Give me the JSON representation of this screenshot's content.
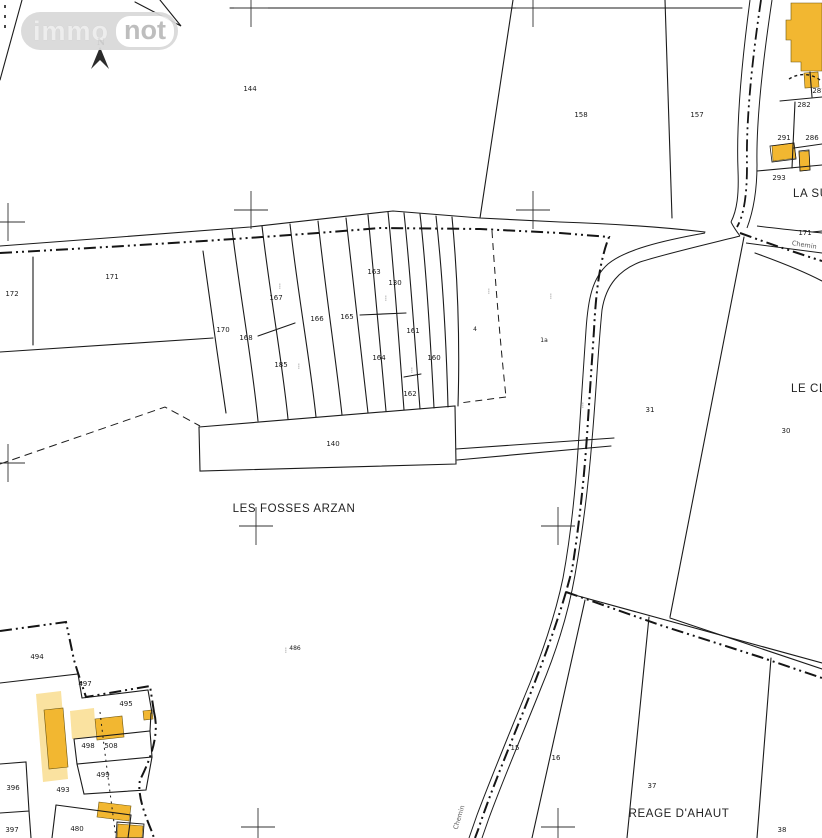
{
  "logo": {
    "immo": "immo",
    "not": "not"
  },
  "north_label": "N",
  "colors": {
    "line": "#1b1b1b",
    "building_dark": "#F2B731",
    "building_light": "#FAE2A0",
    "building_outline": "#6b5510"
  },
  "map": {
    "place_labels": [
      {
        "t": "LES FOSSES ARZAN",
        "x": 294,
        "y": 512,
        "c": "place"
      },
      {
        "t": "REAGE D'AHAUT",
        "x": 679,
        "y": 817,
        "c": "place"
      },
      {
        "t": "LA SU",
        "x": 793,
        "y": 197,
        "c": "place",
        "a": "start"
      },
      {
        "t": "LE CLO",
        "x": 791,
        "y": 392,
        "c": "place",
        "a": "start"
      }
    ],
    "road_labels": [
      {
        "t": "Chemin",
        "x": 804,
        "y": 247,
        "r": 9,
        "c": "road"
      },
      {
        "t": "Chemin",
        "x": 461,
        "y": 818,
        "r": -73,
        "c": "road"
      }
    ],
    "parcel_numbers": [
      {
        "t": "144",
        "x": 250,
        "y": 91
      },
      {
        "t": "158",
        "x": 581,
        "y": 117
      },
      {
        "t": "157",
        "x": 697,
        "y": 117
      },
      {
        "t": "172",
        "x": 12,
        "y": 296
      },
      {
        "t": "171",
        "x": 112,
        "y": 279
      },
      {
        "t": "170",
        "x": 223,
        "y": 332
      },
      {
        "t": "168",
        "x": 246,
        "y": 340
      },
      {
        "t": "167",
        "x": 276,
        "y": 300
      },
      {
        "t": "185",
        "x": 281,
        "y": 367
      },
      {
        "t": "166",
        "x": 317,
        "y": 321
      },
      {
        "t": "165",
        "x": 347,
        "y": 319
      },
      {
        "t": "163",
        "x": 374,
        "y": 274
      },
      {
        "t": "130",
        "x": 395,
        "y": 285
      },
      {
        "t": "164",
        "x": 379,
        "y": 360
      },
      {
        "t": "161",
        "x": 413,
        "y": 333
      },
      {
        "t": "160",
        "x": 434,
        "y": 360
      },
      {
        "t": "162",
        "x": 410,
        "y": 396
      },
      {
        "t": "140",
        "x": 333,
        "y": 446
      },
      {
        "t": "4",
        "x": 475,
        "y": 331,
        "c": "small"
      },
      {
        "t": "1a",
        "x": 544,
        "y": 342,
        "c": "small"
      },
      {
        "t": "486",
        "x": 295,
        "y": 650,
        "c": "small"
      },
      {
        "t": "31",
        "x": 650,
        "y": 412
      },
      {
        "t": "30",
        "x": 786,
        "y": 433
      },
      {
        "t": "15",
        "x": 515,
        "y": 750
      },
      {
        "t": "16",
        "x": 556,
        "y": 760
      },
      {
        "t": "37",
        "x": 652,
        "y": 788
      },
      {
        "t": "38",
        "x": 782,
        "y": 832
      },
      {
        "t": "287",
        "x": 819,
        "y": 93
      },
      {
        "t": "282",
        "x": 804,
        "y": 107
      },
      {
        "t": "291",
        "x": 784,
        "y": 140
      },
      {
        "t": "286",
        "x": 812,
        "y": 140
      },
      {
        "t": "293",
        "x": 779,
        "y": 180
      },
      {
        "t": "171",
        "x": 805,
        "y": 235
      },
      {
        "t": "494",
        "x": 37,
        "y": 659
      },
      {
        "t": "497",
        "x": 85,
        "y": 686
      },
      {
        "t": "495",
        "x": 126,
        "y": 706
      },
      {
        "t": "498",
        "x": 88,
        "y": 748
      },
      {
        "t": "508",
        "x": 111,
        "y": 748
      },
      {
        "t": "499",
        "x": 103,
        "y": 777
      },
      {
        "t": "396",
        "x": 13,
        "y": 790
      },
      {
        "t": "493",
        "x": 63,
        "y": 792
      },
      {
        "t": "480",
        "x": 77,
        "y": 831
      },
      {
        "t": "397",
        "x": 12,
        "y": 832
      }
    ],
    "tiny_marks": [
      {
        "t": "⋮",
        "x": 280,
        "y": 288
      },
      {
        "t": "⋮",
        "x": 386,
        "y": 300
      },
      {
        "t": "⋮",
        "x": 412,
        "y": 372
      },
      {
        "t": "⋮",
        "x": 489,
        "y": 293
      },
      {
        "t": "⋮",
        "x": 551,
        "y": 298
      },
      {
        "t": "⋮",
        "x": 583,
        "y": 407
      },
      {
        "t": "⋮",
        "x": 299,
        "y": 368
      },
      {
        "t": "⋮",
        "x": 286,
        "y": 652
      }
    ],
    "grid_crosses": [
      {
        "x": 251,
        "y": 8
      },
      {
        "x": 533,
        "y": 8
      },
      {
        "x": 8,
        "y": 222
      },
      {
        "x": 251,
        "y": 210
      },
      {
        "x": 533,
        "y": 210
      },
      {
        "x": 8,
        "y": 463
      },
      {
        "x": 256,
        "y": 526
      },
      {
        "x": 558,
        "y": 526
      },
      {
        "x": 258,
        "y": 827
      },
      {
        "x": 558,
        "y": 827
      }
    ],
    "buildings": [
      {
        "fill": "light",
        "pts": "36,694 61,691 68,779 43,782"
      },
      {
        "fill": "dark",
        "pts": "44,710 63,708 68,767 49,769"
      },
      {
        "fill": "light",
        "pts": "70,711 94,708 96,736 72,739"
      },
      {
        "fill": "dark",
        "pts": "95,719 122,716 124,737 97,740"
      },
      {
        "fill": "dark",
        "pts": "143,711 152,710 153,719 144,720"
      },
      {
        "fill": "dark",
        "pts": "99,802 131,806 129,821 97,817"
      },
      {
        "fill": "dark",
        "pts": "118,824 143,826 142,838 117,838"
      },
      {
        "fill": "dark",
        "pts": "791,3 822,3 822,71 801,71 801,62 791,62 791,40 786,40 786,20 791,20"
      },
      {
        "fill": "dark",
        "pts": "804,73 818,72 819,87 805,88"
      },
      {
        "fill": "dark",
        "pts": "772,146 794,143 796,158 773,161"
      },
      {
        "fill": "dark",
        "pts": "799,152 809,151 810,170 800,171"
      }
    ]
  }
}
